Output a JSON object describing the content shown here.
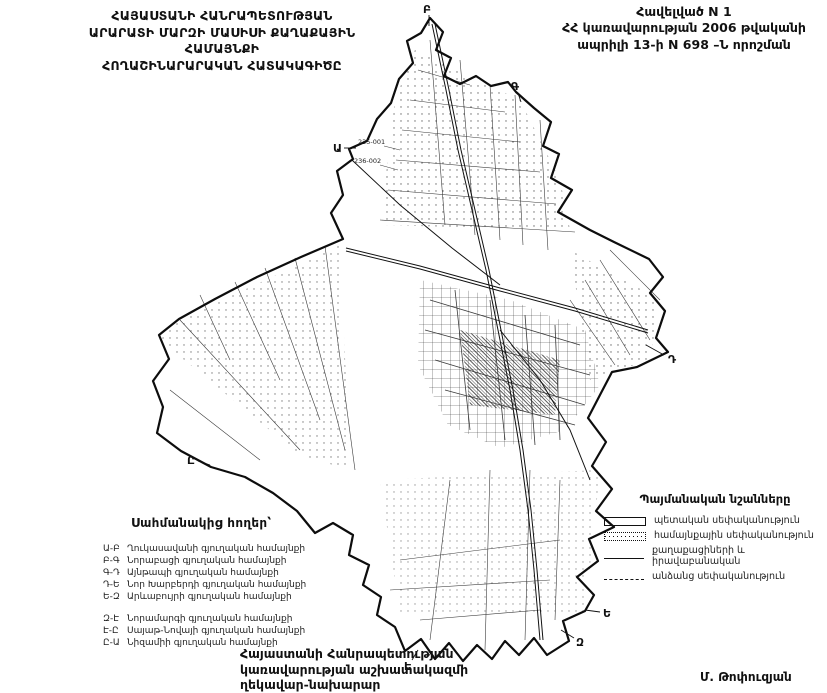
{
  "header": {
    "title_lines": [
      "ՀԱՅԱՍՏԱՆԻ ՀԱՆՐԱՊԵՏՈՒԹՅԱՆ",
      "ԱՐԱՐԱՏԻ ՄԱՐԶԻ ՄԱՍԻՍԻ ՔԱՂԱՔԱՅԻՆ ՀԱՄԱՅՆՔԻ",
      "ՀՈՂԱՇԻՆԱՐԱՐԱԿԱՆ ՀԱՏԱԿԱԳԻԾԸ"
    ],
    "annex_lines": [
      "Հավելված N 1",
      "ՀՀ կառավարության  2006 թվականի",
      "ապրիլի 13-ի N 698 –Ն որոշման"
    ]
  },
  "map": {
    "boundary_points": [
      {
        "label": "Ա"
      },
      {
        "label": "Բ"
      },
      {
        "label": "Գ"
      },
      {
        "label": "Դ"
      },
      {
        "label": "Ե"
      },
      {
        "label": "Զ"
      },
      {
        "label": "Է"
      },
      {
        "label": "Ը"
      }
    ],
    "parcel_labels": [
      {
        "text": "235-001"
      },
      {
        "text": "236-002"
      }
    ]
  },
  "legend_symbols": {
    "title": "Պայմանական նշանները",
    "items": [
      {
        "symbol": "solid-box",
        "label": "պետական սեփականություն"
      },
      {
        "symbol": "dotted-box",
        "label": "համայնքային սեփականություն"
      },
      {
        "symbol": "solid-line",
        "label": "քաղաքացիների և իրավաբանական"
      },
      {
        "symbol": "dashed-line",
        "label": "անձանց սեփականություն"
      }
    ]
  },
  "legend_borders": {
    "title": "Սահմանակից հողեր՝",
    "group1": [
      {
        "code": "Ա-Բ",
        "name": "Ղուկասավանի գյուղական համայնքի"
      },
      {
        "code": "Բ-Գ",
        "name": "Նորաբացի գյուղական համայնքի"
      },
      {
        "code": "Գ-Դ",
        "name": "Այնթապի գյուղական համայնքի"
      },
      {
        "code": "Դ-Ե",
        "name": "Նոր Խարբերդի գյուղական համայնքի"
      },
      {
        "code": "Ե-Զ",
        "name": "Արևաբույրի գյուղական համայնքի"
      }
    ],
    "group2": [
      {
        "code": "Զ-Է",
        "name": "Նորամարգի գյուղական համայնքի"
      },
      {
        "code": "Է-Ը",
        "name": "Սայաթ-Նովայի գյուղական համայնքի"
      },
      {
        "code": "Ը-Ա",
        "name": "Նիզամիի գյուղական համայնքի"
      }
    ]
  },
  "footer": {
    "signature_lines": [
      "Հայաստանի Հանրապետության",
      "կառավարության աշխատակազմի",
      "ղեկավար-նախարար"
    ],
    "signatory": "Մ. Թոփուզյան"
  },
  "colors": {
    "ink": "#111111",
    "paper": "#ffffff"
  }
}
